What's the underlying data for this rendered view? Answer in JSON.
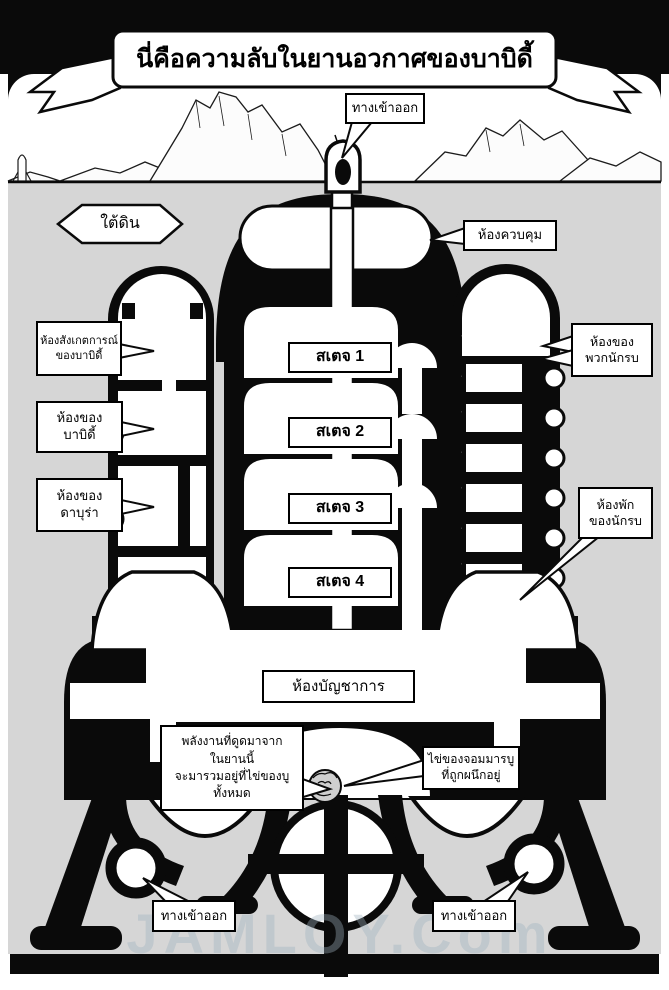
{
  "page": {
    "title": "นี่คือความลับในยานอวกาศของบาบิดี้",
    "watermark": "JAMLOY.Com"
  },
  "labels": {
    "underground": "ใต้ดิน",
    "entrance_top": "ทางเข้าออก",
    "control_room": "ห้องควบคุม",
    "observation": [
      "ห้องสังเกตการณ์",
      "ของบาบิดี้"
    ],
    "babidi": [
      "ห้องของ",
      "บาบิดี้"
    ],
    "dabura": [
      "ห้องของ",
      "ดาบุร่า"
    ],
    "warriors": [
      "ห้องของ",
      "พวกนักรบ"
    ],
    "quarters": [
      "ห้องพัก",
      "ของนักรบ"
    ],
    "stages": [
      "สเตจ 1",
      "สเตจ 2",
      "สเตจ 3",
      "สเตจ 4"
    ],
    "command_room": "ห้องบัญชาการ",
    "energy": [
      "พลังงานที่ดูดมาจาก",
      "ในยานนี้",
      "จะมารวมอยู่ที่ไข่ของบู",
      "ทั้งหมด"
    ],
    "egg": [
      "ไข่ของจอมมารบู",
      "ที่ถูกผนึกอยู่"
    ],
    "entrance_bottom_left": "ทางเข้าออก",
    "entrance_bottom_right": "ทางเข้าออก"
  },
  "colors": {
    "ink": "#0a0a0a",
    "paper": "#ffffff",
    "ground": "#d6d6d6"
  }
}
